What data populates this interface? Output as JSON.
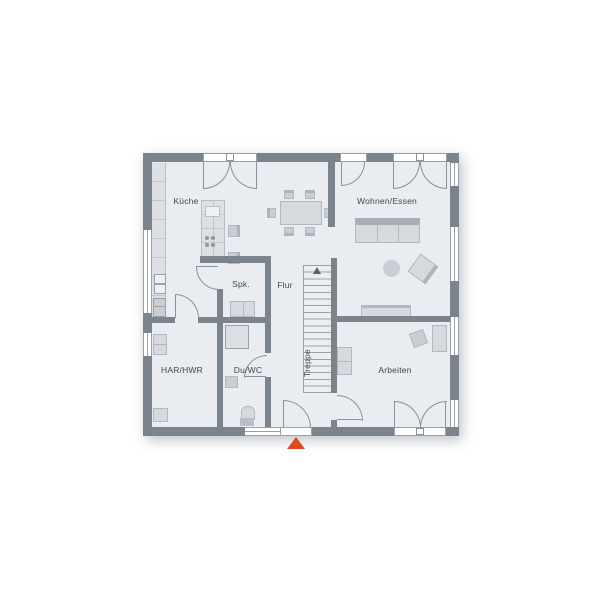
{
  "rooms": {
    "kueche": "Küche",
    "wohnen_essen": "Wohnen/Essen",
    "spk": "Spk.",
    "flur": "Flur",
    "treppe": "Treppe",
    "har_hwr": "HAR/HWR",
    "du_wc": "Du/WC",
    "arbeiten": "Arbeiten"
  },
  "colors": {
    "wall": "#7b838c",
    "floor": "#e9ecf0",
    "furniture": "#d6dade",
    "furniture_dark": "#a7adb5",
    "line": "#8a929b",
    "entrance_marker": "#dc4a1e",
    "label_text": "#41474e"
  }
}
